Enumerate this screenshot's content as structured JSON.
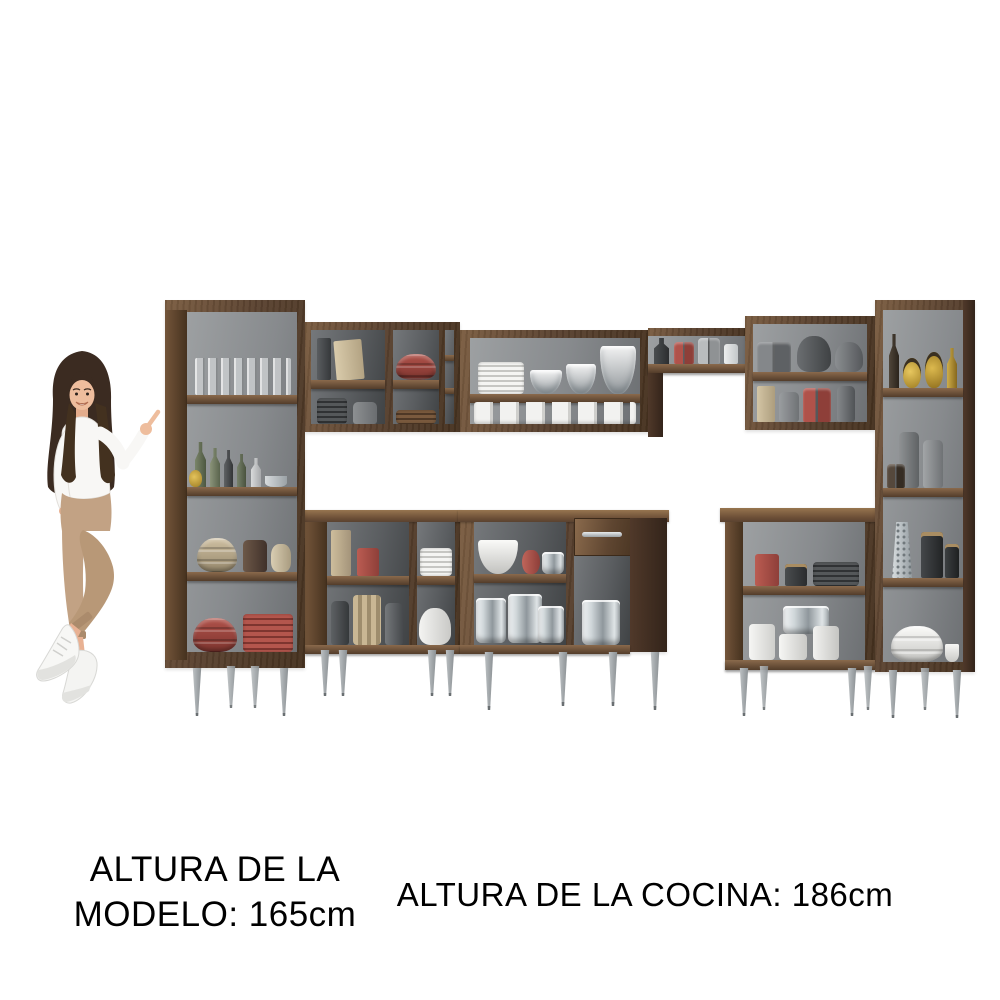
{
  "captions": {
    "model_line1": "ALTURA DE LA",
    "model_line2": "MODELO: 165cm",
    "kitchen": "ALTURA DE LA COCINA: 186cm"
  },
  "colors": {
    "background": "#ffffff",
    "text": "#000000",
    "wood": "#5a4230",
    "wood_dark": "#46321f",
    "wood_light": "#7b5d41",
    "interior_gray": "#8f9294",
    "leg_metal": "#a7abae",
    "red_item": "#b0524a",
    "cream_item": "#cfc0a2",
    "steel_item": "#c3cacd",
    "white_item": "#f2f2f1",
    "gray_item": "#7e8183",
    "dark_item": "#3c3f41",
    "amber_item": "#c09a3e",
    "green_item": "#677258",
    "skin": "#eebd9d",
    "hair": "#3b2b21",
    "blouse": "#f8f7f5",
    "pants": "#c2a284",
    "shoes": "#f5f5f3"
  },
  "kitchen_set": {
    "style": "open modular corner kitchen, dark walnut wood, gray interiors, tapered metal feet",
    "cabinets": [
      {
        "name": "left-tall-pantry",
        "contents": [
          "drinking glasses",
          "bottles and jug",
          "beige bowls and jars",
          "red bowls and red plates"
        ]
      },
      {
        "name": "upper-cabinet-left",
        "contents": [
          "books and boxes",
          "gray dishes",
          "red bowls",
          "wooden plates"
        ]
      },
      {
        "name": "upper-cabinet-middle",
        "contents": [
          "white plates and glass bowls",
          "stacked white cups"
        ]
      },
      {
        "name": "bridge-shelf",
        "contents": [
          "bottles, red and gray canisters"
        ]
      },
      {
        "name": "upper-cabinet-right",
        "contents": [
          "gray mugs and teapots",
          "box, jars, red canisters, vase"
        ]
      },
      {
        "name": "right-tall-pantry",
        "contents": [
          "bottle and amber oil cruets",
          "gray canisters and jars",
          "grater and black jars",
          "white bowls"
        ]
      },
      {
        "name": "base-cabinet-left",
        "contents": [
          "boxes and red canister",
          "vases and jars",
          "white plates",
          "white teapot"
        ]
      },
      {
        "name": "base-cabinet-drawer",
        "contents": [
          "white bowl, red pitcher, pot",
          "stainless pots",
          "drawer with metal handle",
          "stainless stock pot"
        ]
      },
      {
        "name": "base-cabinet-right",
        "contents": [
          "red and black canisters, dark plates",
          "stainless lidded pot and white canisters"
        ]
      }
    ]
  },
  "model": {
    "pose": "standing and pointing at the kitchen set",
    "outfit": [
      "white long-sleeve top",
      "beige cropped trousers",
      "white sneakers"
    ]
  }
}
